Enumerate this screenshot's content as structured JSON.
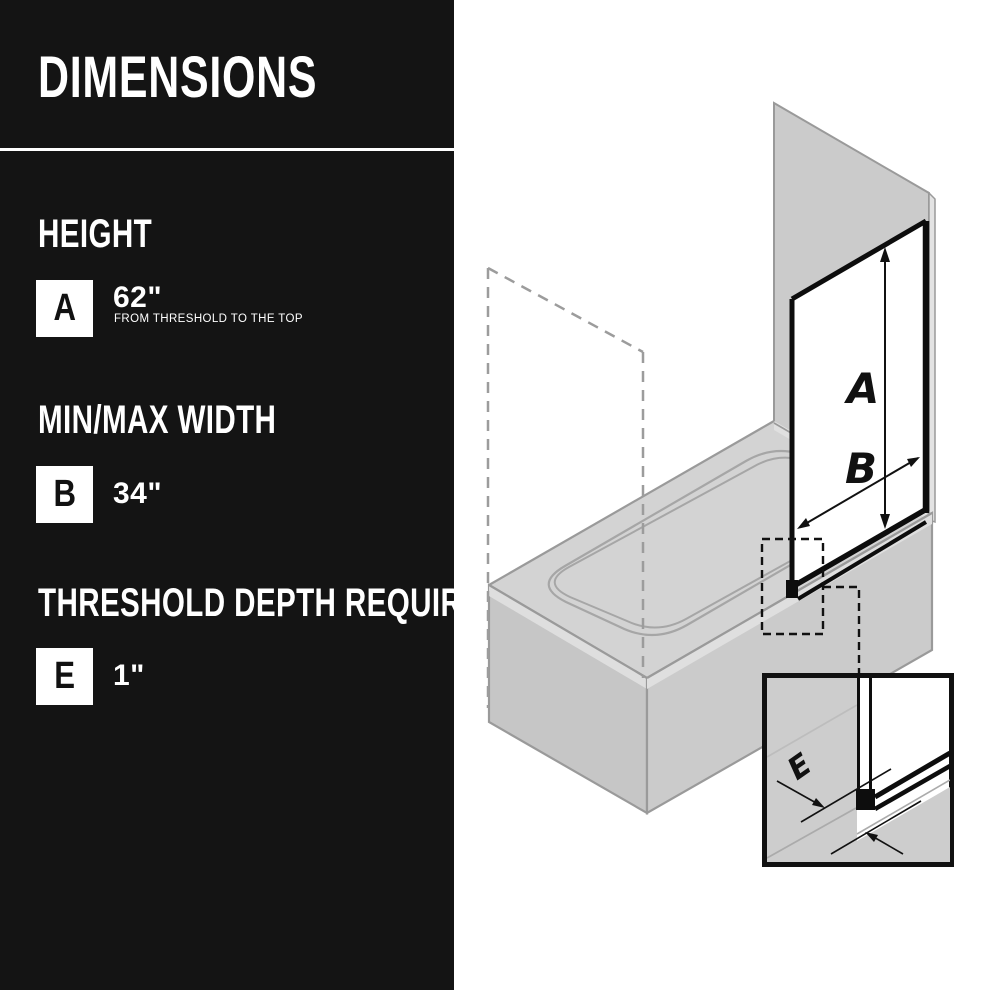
{
  "sidebar": {
    "bg_color": "#141414",
    "title": "DIMENSIONS",
    "sections": [
      {
        "heading": "HEIGHT",
        "badge": "A",
        "value": "62\"",
        "note": "FROM THRESHOLD TO THE TOP"
      },
      {
        "heading": "MIN/MAX WIDTH",
        "badge": "B",
        "value": "34\""
      },
      {
        "heading": "THRESHOLD DEPTH REQUIRED",
        "badge": "E",
        "value": "1\""
      }
    ]
  },
  "diagram": {
    "description": "Isometric drawing of a bathtub with glass screen panel and threshold detail inset",
    "labels": {
      "height_arrow": "A",
      "width_arrow": "B",
      "threshold_arrow": "E"
    },
    "colors": {
      "tub_fill": "#cdcdcd",
      "tub_outline": "#999999",
      "wall_fill": "#cbcbcb",
      "wall_edge": "#e3e3e3",
      "panel_frame": "#0d0d0d",
      "basin_line": "#a6a6a6",
      "dashed_phantom": "#9c9c9c",
      "callout_dash": "#111111"
    }
  }
}
